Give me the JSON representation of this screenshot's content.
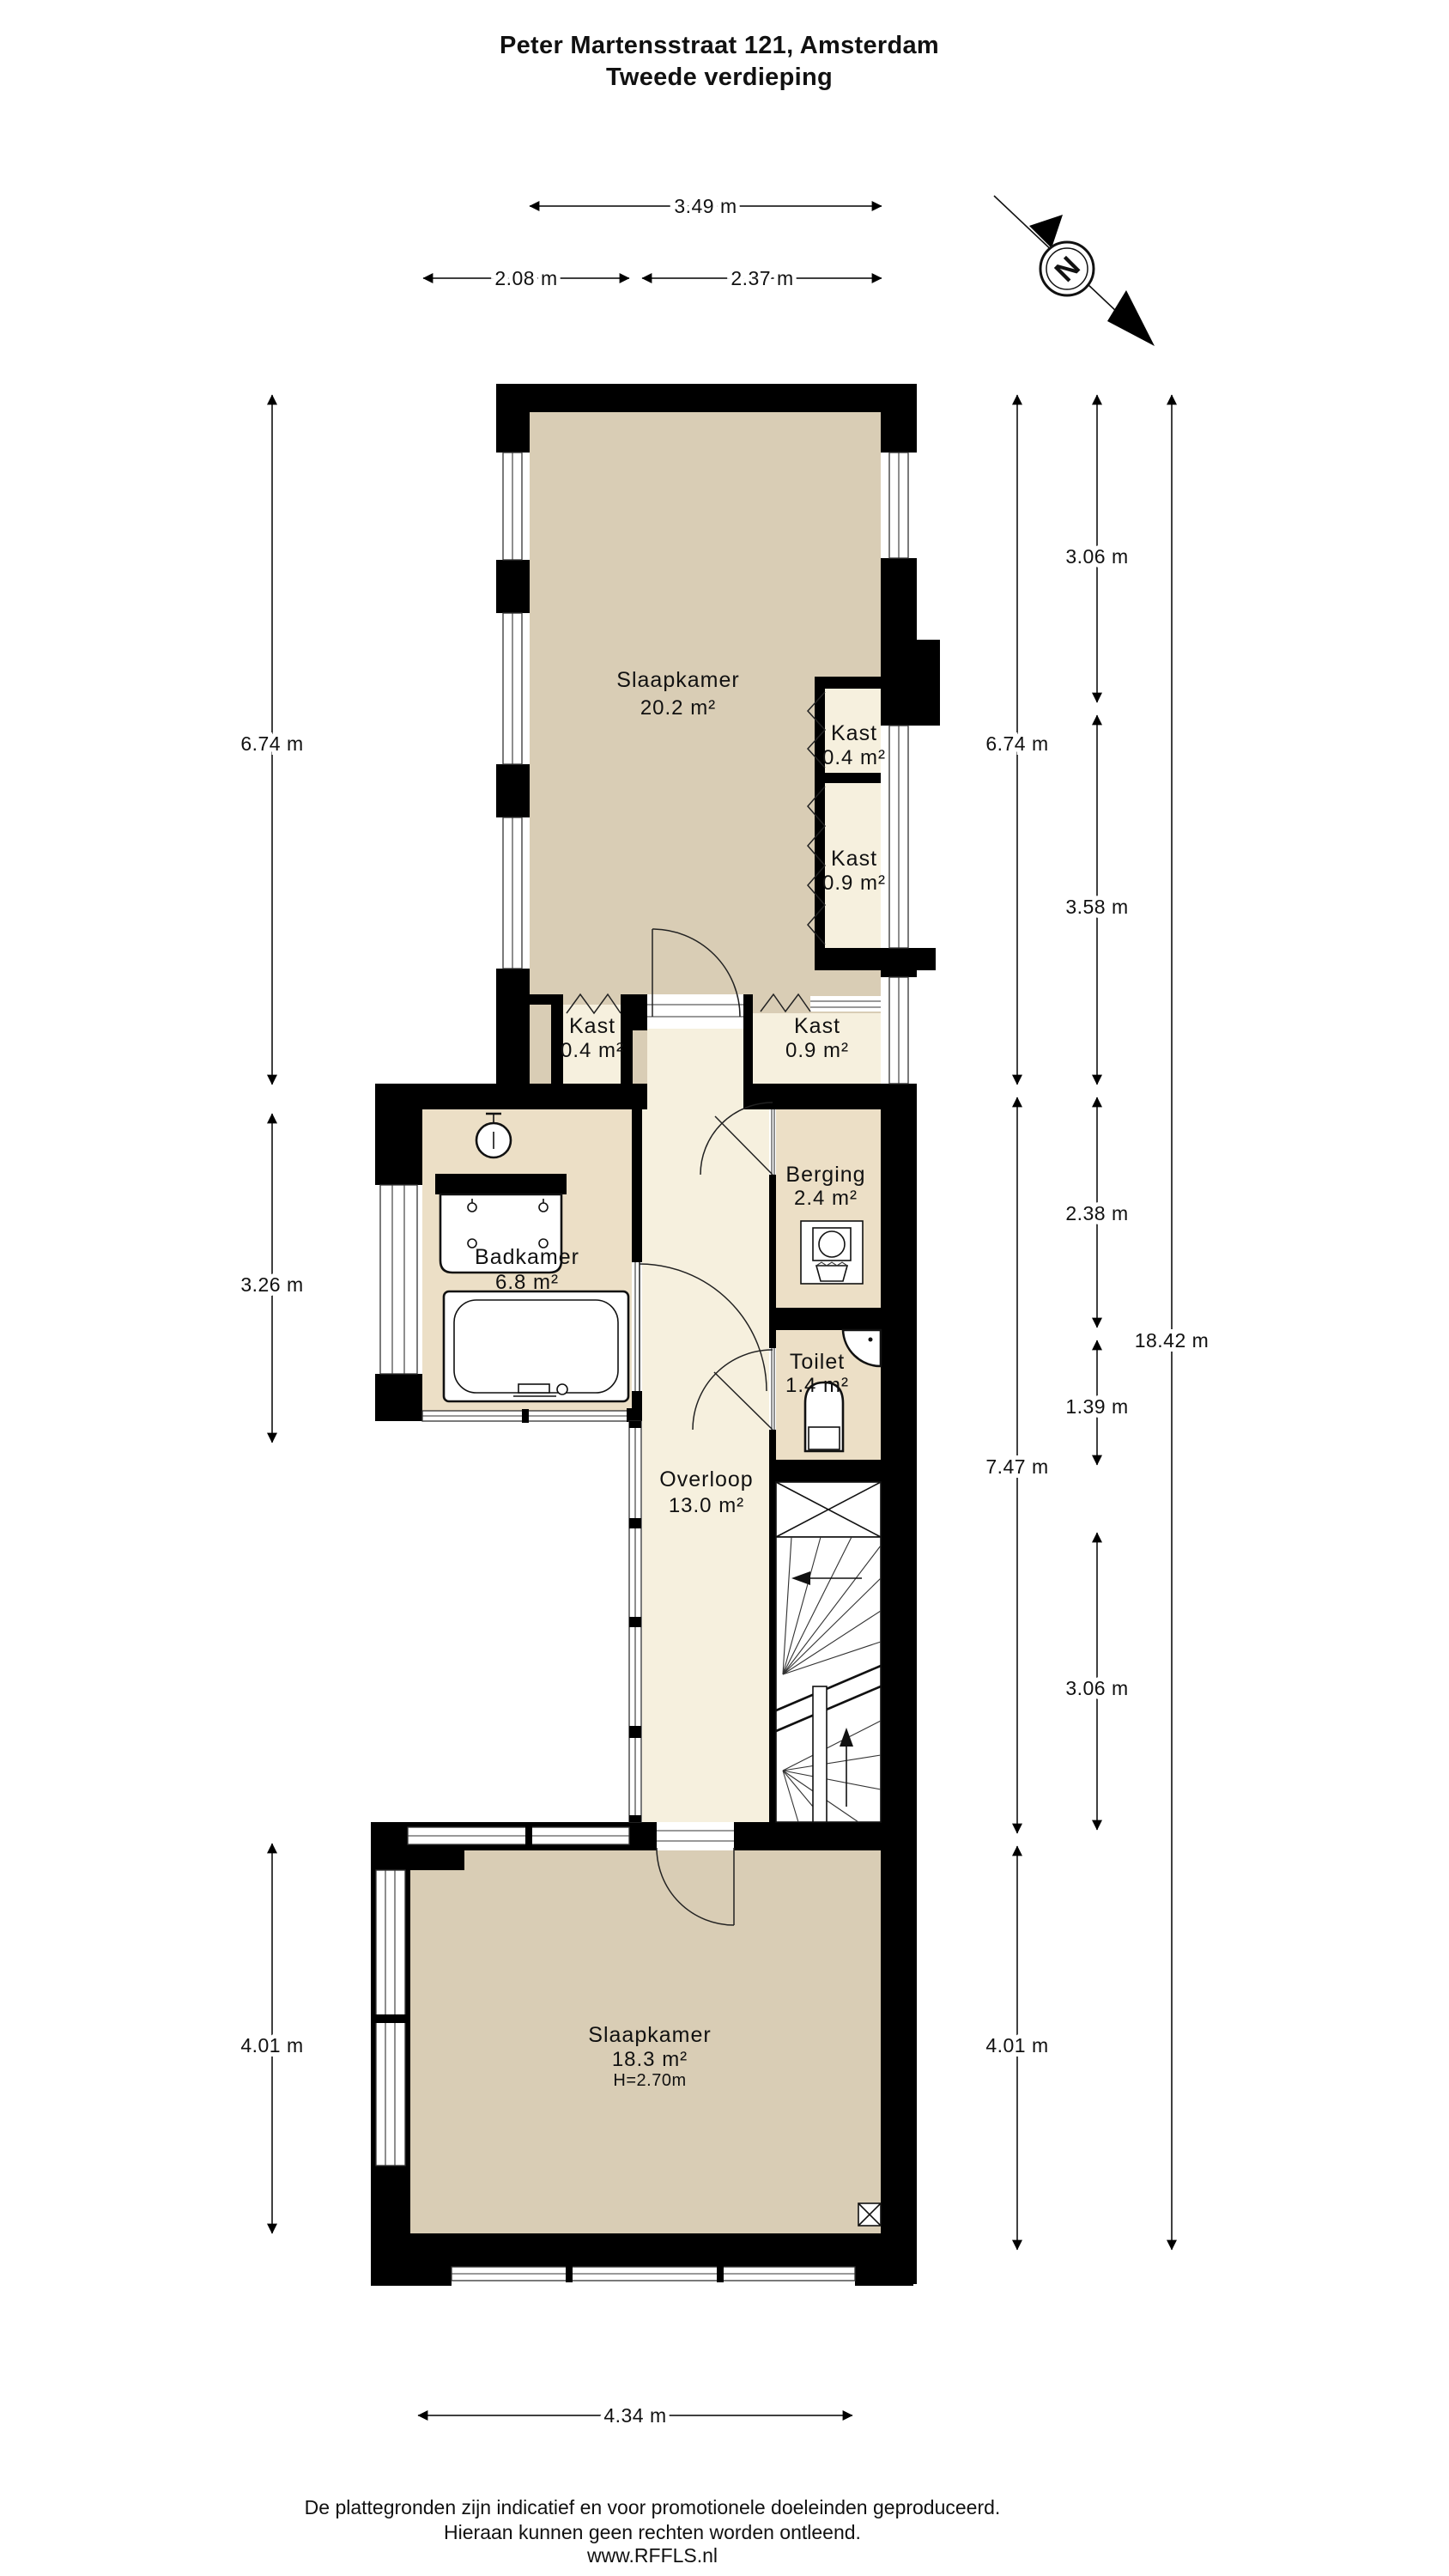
{
  "title": {
    "line1": "Peter Martensstraat 121, Amsterdam",
    "line2": "Tweede verdieping"
  },
  "compass": {
    "letter": "N"
  },
  "rooms": {
    "slaapkamer_boven": {
      "name": "Slaapkamer",
      "area": "20.2 m²"
    },
    "kast_rechts_boven": {
      "name": "Kast",
      "area": "0.4 m²"
    },
    "kast_rechts": {
      "name": "Kast",
      "area": "0.9 m²"
    },
    "kast_links_onder": {
      "name": "Kast",
      "area": "0.4 m²"
    },
    "kast_rechts_onder": {
      "name": "Kast",
      "area": "0.9 m²"
    },
    "badkamer": {
      "name": "Badkamer",
      "area": "6.8 m²"
    },
    "berging": {
      "name": "Berging",
      "area": "2.4 m²"
    },
    "toilet": {
      "name": "Toilet",
      "area": "1.4 m²"
    },
    "overloop": {
      "name": "Overloop",
      "area": "13.0 m²"
    },
    "slaapkamer_beneden": {
      "name": "Slaapkamer",
      "area": "18.3 m²",
      "height": "H=2.70m"
    }
  },
  "dimensions": {
    "top": [
      "3.49 m",
      "2.08 m",
      "2.37 m"
    ],
    "left": [
      "6.74 m",
      "3.26 m",
      "4.01 m"
    ],
    "right_inner": [
      "6.74 m",
      "7.47 m",
      "4.01 m"
    ],
    "right_middle": [
      "3.06 m",
      "3.58 m",
      "2.38 m",
      "1.39 m",
      "3.06 m"
    ],
    "right_outer": [
      "18.42 m"
    ],
    "bottom": [
      "4.34 m"
    ]
  },
  "footer": {
    "line1": "De plattegronden zijn indicatief en voor promotionele doeleinden geproduceerd.",
    "line2": "Hieraan kunnen geen rechten worden ontleend.",
    "line3": "www.RFFLS.nl"
  },
  "colors": {
    "wall": "#000000",
    "bedroom_fill": "#d9cdb5",
    "bathroom_fill": "#ecdfc6",
    "hallway_fill": "#f6f0de",
    "background": "#ffffff"
  }
}
